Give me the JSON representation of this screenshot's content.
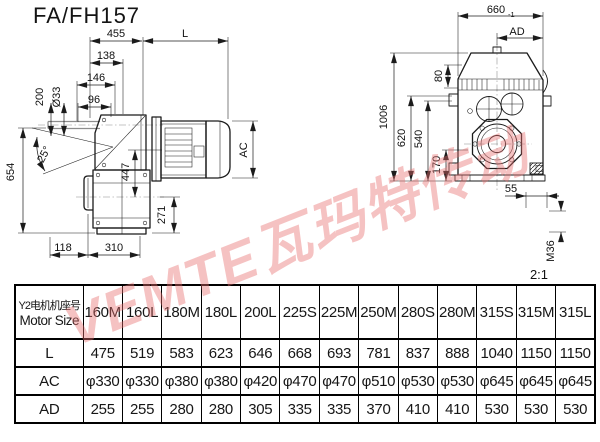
{
  "title": "FA/FH157",
  "watermark": "VEMTE瓦玛特传动",
  "scale_note": "2:1",
  "left_view": {
    "dims": {
      "d455": "455",
      "dL": "L",
      "d138": "138",
      "d146": "146",
      "d96": "96",
      "d200": "200",
      "d33": "Ø33",
      "d25": "25°",
      "d654": "654",
      "d447": "447",
      "dAC": "AC",
      "d271": "271",
      "d118": "118",
      "d310": "310"
    }
  },
  "right_view": {
    "dims": {
      "d660": "660",
      "d660_tol": "-1",
      "dAD": "AD",
      "d80": "80",
      "d1006": "1006",
      "d620": "620",
      "d540": "540",
      "d170": "170",
      "d55": "55",
      "dM36": "M36"
    }
  },
  "table": {
    "header_cn": "Y2电机机座号",
    "header_en": "Motor Size",
    "columns": [
      "160M",
      "160L",
      "180M",
      "180L",
      "200L",
      "225S",
      "225M",
      "250M",
      "280S",
      "280M",
      "315S",
      "315M",
      "315L"
    ],
    "rows": [
      {
        "label": "L",
        "values": [
          "475",
          "519",
          "583",
          "623",
          "646",
          "668",
          "693",
          "781",
          "837",
          "888",
          "1040",
          "1150",
          "1150"
        ]
      },
      {
        "label": "AC",
        "values": [
          "φ330",
          "φ330",
          "φ380",
          "φ380",
          "φ420",
          "φ470",
          "φ470",
          "φ510",
          "φ530",
          "φ530",
          "φ645",
          "φ645",
          "φ645"
        ]
      },
      {
        "label": "AD",
        "values": [
          "255",
          "255",
          "280",
          "280",
          "305",
          "335",
          "335",
          "370",
          "410",
          "410",
          "530",
          "530",
          "530"
        ]
      }
    ]
  }
}
